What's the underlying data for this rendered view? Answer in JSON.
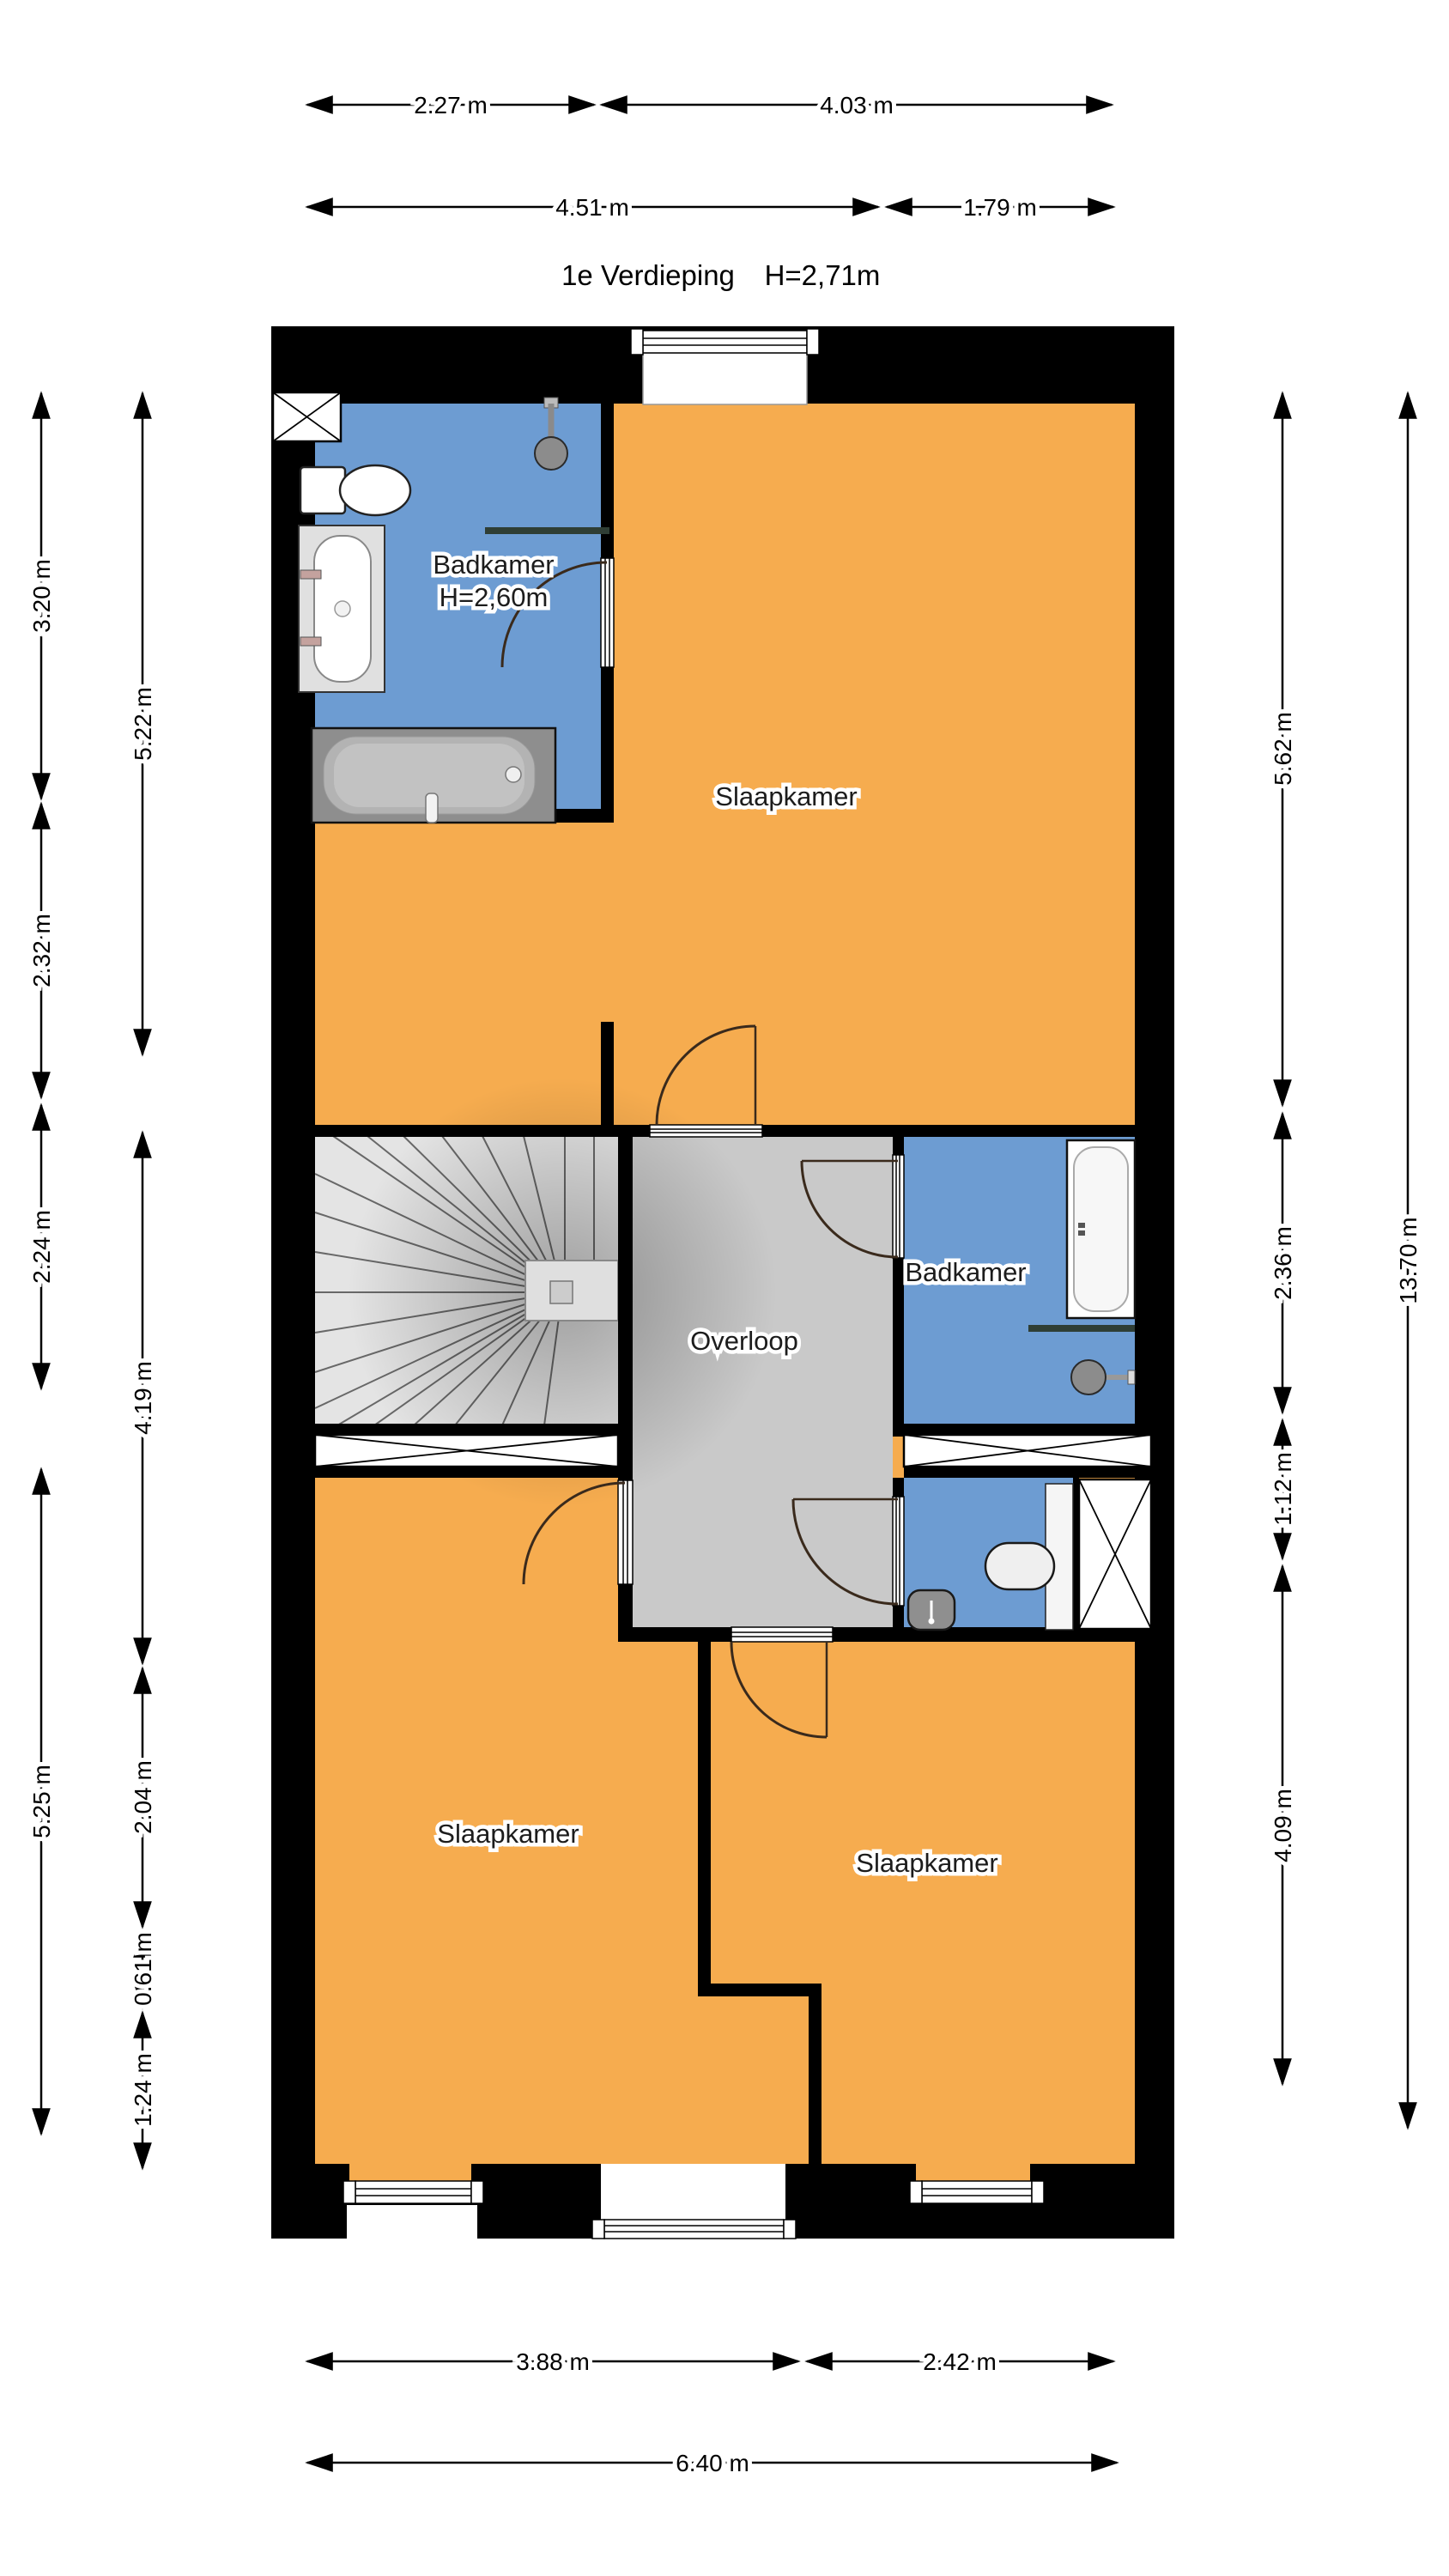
{
  "title": {
    "floor": "1e Verdieping",
    "ceiling_height": "H=2,71m"
  },
  "rooms": {
    "bathroom_top": {
      "name": "Badkamer",
      "height": "H=2,60m"
    },
    "bedroom_top": "Slaapkamer",
    "landing": "Overloop",
    "bathroom_mid": "Badkamer",
    "bedroom_bottom_left": "Slaapkamer",
    "bedroom_bottom_right": "Slaapkamer"
  },
  "dimensions": {
    "top_row1": [
      "2.27 m",
      "4.03 m"
    ],
    "top_row2": [
      "4.51 m",
      "1.79 m"
    ],
    "left_outer": [
      "3.20 m",
      "2.32 m",
      "2.24 m",
      "5.25 m"
    ],
    "left_inner": [
      "5.22 m",
      "4.19 m",
      "2.04 m",
      "0.61 m",
      "1.24 m"
    ],
    "right_inner": [
      "5.62 m",
      "2.36 m",
      "1.12 m",
      "4.09 m"
    ],
    "right_outer": [
      "13.70 m"
    ],
    "bottom_row1": [
      "3.88 m",
      "2.42 m"
    ],
    "bottom_row2": [
      "6.40 m"
    ]
  },
  "colors": {
    "bedroom": "#F6AC4F",
    "bathroom": "#6D9CD2",
    "landing": "#C9C9C9",
    "stairs": "#E4E4E4",
    "wall": "#000000",
    "screen": "#2F3E35"
  }
}
